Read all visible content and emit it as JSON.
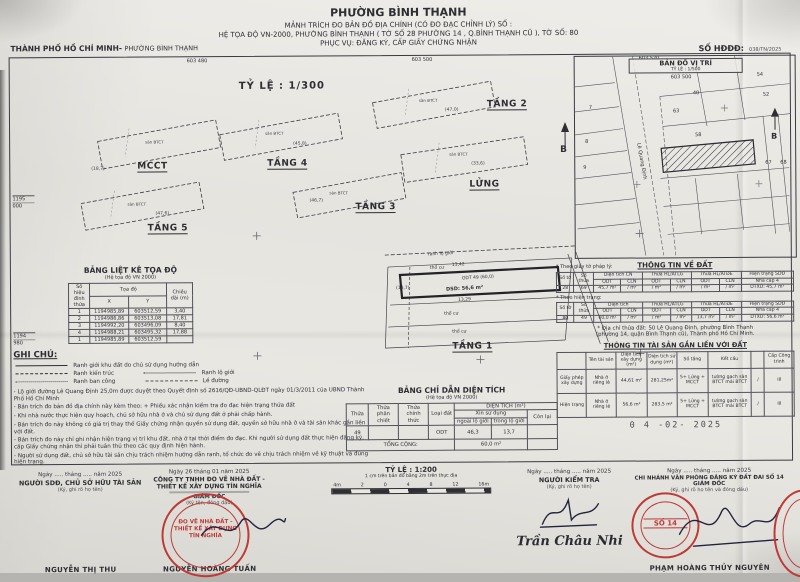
{
  "header": {
    "left_bold": "THÀNH PHỐ HỒ CHÍ MINH-",
    "left_rest": "PHƯỜNG BÌNH THẠNH",
    "title": "PHƯỜNG BÌNH THẠNH",
    "line1": "MẢNH TRÍCH ĐO BẢN ĐỒ ĐỊA CHÍNH (CÓ ĐO ĐẠC CHỈNH LÝ) SỐ :",
    "line2": "HỆ TỌA ĐỘ VN-2000, PHƯỜNG BÌNH THẠNH ( TỜ SỐ 28 PHƯỜNG 14 , Q.BÌNH THẠNH CŨ ), TỜ SỐ: 80",
    "line3": "PHỤC VỤ: ĐĂNG KÝ, CẤP GIẤY CHỨNG NHẬN",
    "so_hddd_label": "SỐ HĐĐĐ:",
    "so_hddd_value": "038/TN/2025"
  },
  "map": {
    "scale_label": "TỶ LỆ : 1/300",
    "coords_top": [
      "603 480",
      "603 500",
      "603 520"
    ],
    "coords_left": [
      "1195",
      "000",
      "1194",
      "980"
    ],
    "north": "B",
    "floors": [
      {
        "label": "MCCT",
        "area": "(18,7)",
        "note": "sàn BTCT"
      },
      {
        "label": "TẦNG 4",
        "area": "(45,8)",
        "note": "sàn BTCT"
      },
      {
        "label": "TẦNG 2",
        "area": "(47,0)",
        "note": "sàn BTCT"
      },
      {
        "label": "TẦNG 5",
        "area": "(47,6)",
        "note": "sàn BTCT"
      },
      {
        "label": "TẦNG 3",
        "area": "(46,7)",
        "note": "sàn BTCT"
      },
      {
        "label": "LỬNG",
        "area": "(33,6)",
        "note": "sàn BTCT"
      },
      {
        "label": "TẦNG 1"
      }
    ],
    "tang1": {
      "ranh": "ranh lộ giới",
      "dim_top": "13,42",
      "odt": "ODT  49  (60,0)",
      "dsd": "DSD: 56,6 m²",
      "dim_bot": "13,29",
      "left_area": "(18,7)",
      "tho_cu": "thổ cư"
    }
  },
  "inset": {
    "title": "BẢN ĐỒ VỊ TRÍ",
    "scale": "TỶ LỆ : 1/500",
    "north": "B",
    "coord": "603 500",
    "street": "Lê Quang Định",
    "parcels": [
      "7",
      "8",
      "9",
      "40",
      "63",
      "52",
      "54",
      "58",
      "67",
      "68"
    ]
  },
  "toado": {
    "title": "BẢNG LIỆT KÊ TỌA ĐỘ",
    "subtitle": "(Hệ tọa độ VN 2000)",
    "col_point": "Số hiệu đỉnh thửa",
    "col_coord": "Tọa độ",
    "col_x": "X",
    "col_y": "Y",
    "col_len": "Chiều dài (m)",
    "rows": [
      [
        "1",
        "1194985,89",
        "603512,59",
        "3,40"
      ],
      [
        "2",
        "1194986,86",
        "603513,08",
        "17,81"
      ],
      [
        "3",
        "1194992,20",
        "603496,09",
        "8,40"
      ],
      [
        "4",
        "1194988,21",
        "603495,32",
        "17,88"
      ],
      [
        "1",
        "1194985,89",
        "603512,59",
        ""
      ]
    ]
  },
  "ghichu": {
    "title": "GHI CHÚ:",
    "leg1": "Ranh giới khu đất do chủ sử dụng hướng dẫn",
    "leg2a": "Ranh kiến trúc",
    "leg2b": "Ranh lộ giới",
    "leg3a": "Ranh ban công",
    "leg3b": "Lề đường",
    "notes": [
      "- Lộ giới đường Lê Quang Định 25,0m được duyệt theo Quyết định số 2616/QĐ-UBND-QLĐT ngày 01/3/2011 của UBND Thành Phố Hồ Chí Minh",
      "- Bản trích đo bản đồ địa chính này kèm theo: + Phiếu xác nhận kiểm tra đo đạc hiện trạng thửa đất",
      "- Khi nhà nước thực hiện quy hoạch, chủ sở hữu nhà ở và chủ sử dụng đất ở phải chấp hành.",
      "- Bản trích đo này không có giá trị thay thế Giấy chứng nhận quyền sử dụng đất, quyền sở hữu nhà ở và tài sản khác gắn liền với đất.",
      "- Bản trích đo này chỉ ghi nhận hiện trạng vị trí khu đất, nhà ở tại thời điểm đo đạc. Khi người sử dụng đất thực hiện đăng ký, cấp Giấy chứng nhận thì phải tuân thủ theo các quy định hiện hành.",
      "- Người sử dụng đất, chủ sở hữu tài sản chịu trách nhiệm hướng dẫn ranh, tổ chức đo vẽ chịu trách nhiệm về kỹ thuật và đúng hiện trạng."
    ]
  },
  "dientich": {
    "title": "BẢNG CHỈ DẪN DIỆN TÍCH",
    "subtitle": "(Hệ tọa độ VN 2000)",
    "h_thua": "Thửa",
    "h_phanchiet": "Thửa phân chiết",
    "h_chinhthuc": "Thửa chính thức",
    "h_loaidat": "Loại đất",
    "h_dientich": "DIỆN TÍCH (m²)",
    "h_xinsudung": "Xin sử dụng",
    "h_conlai": "Còn lại",
    "h_ngoai": "ngoài lộ giới",
    "h_trong": "trong lộ giới",
    "row": [
      "49",
      "",
      "",
      "ODT",
      "46,3",
      "13,7",
      ""
    ],
    "total_label": "TỔNG CỘNG:",
    "total_value": "60,0 m²"
  },
  "dat": {
    "title": "THÔNG TIN VỀ ĐẤT",
    "note_legal": "* Theo giấy tờ pháp lý:",
    "note_current": "* Theo hiện trạng:",
    "h_soto": "Số tờ",
    "h_sothua": "Số thửa",
    "h_dtcn": "Diện tích CN",
    "h_dt": "Diện tích",
    "h_hl": "Thửa HL/ATLG",
    "h_atde": "Thửa HL/ATĐE",
    "h_ht": "Hiện trạng SDĐ",
    "h_odt": "ODT",
    "h_cln": "CLN",
    "h_nha": "Nhà cấp 4",
    "legal_row": [
      [
        "28",
        "69",
        "45,7 m²",
        "/ m²",
        "/ m²",
        "/ m²",
        "/ m²",
        "/ m²",
        "DTXD: 45,7 m²"
      ]
    ],
    "current_row": [
      [
        "80",
        "49",
        "60,0 m²",
        "/ m²",
        "/ m²",
        "/ m²",
        "13,7 m²",
        "/ m²",
        "DTXD: 56,6 m²"
      ]
    ],
    "address1": "* Địa chỉ thửa đất: 50 Lê Quang Định, phường Bình Thạnh",
    "address2": "(phường 14, quận Bình Thạnh cũ), Thành phố Hồ Chí Minh."
  },
  "taisan": {
    "title": "THÔNG TIN TÀI SẢN GẮN LIỀN VỚI ĐẤT",
    "h_ten": "Tên tài sản",
    "h_dtxd": "Diện tích xây dựng (m²)",
    "h_dtsd": "Diện tích sử dụng (m²)",
    "h_sotang": "Số tầng",
    "h_ketcau": "Kết cấu",
    "h_cap": "Cấp Công trình",
    "rows": [
      [
        "Giấy phép xây dựng",
        "Nhà ở riêng lẻ",
        "44,61 m²",
        "281,25m²",
        "5+ Lửng + MCCT",
        "tường gạch sàn BTCT mái BTCT",
        "/",
        "III"
      ],
      [
        "Hiện trạng",
        "Nhà ở riêng lẻ",
        "56,6 m²",
        "283,5 m²",
        "5+ Lửng + MCCT",
        "tường gạch sàn BTCT mái BTCT",
        "/",
        "III"
      ]
    ],
    "date_stamp": "0 4  -02-  2025"
  },
  "signatures": {
    "s1": {
      "date": "Ngày ..... tháng ..... năm 2025",
      "role": "NGƯỜI SDĐ, CHỦ SỞ HỮU TÀI SẢN",
      "note": "(Ký, ghi rõ họ tên)",
      "name": "NGUYỄN THỊ THU"
    },
    "s2": {
      "date": "Ngày 26 tháng 01 năm 2025",
      "org1": "CÔNG TY TNHH ĐO VẼ NHÀ ĐẤT -",
      "org2": "THIẾT KẾ XÂY DỰNG TÍN NGHĨA",
      "role": "GIÁM ĐỐC",
      "note": "(Ký tên, đóng dấu)",
      "name": "NGUYỄN HOÀNG TUẤN",
      "stamp": [
        "ĐO VẼ NHÀ ĐẤT -",
        "THIẾT KẾ XÂY DỰNG",
        "TÍN NGHĨA"
      ]
    },
    "scale200": {
      "label": "TỶ LỆ : 1:200",
      "sub": "1 cm trên bản đồ bằng 2m trên thực địa",
      "ticks": [
        "4m",
        "2",
        "0",
        "4",
        "8",
        "12",
        "16m"
      ]
    },
    "s3": {
      "date": "Ngày ..... tháng ..... năm 2025",
      "role": "NGƯỜI KIỂM TRA",
      "note": "(Ký, ghi rõ họ tên)",
      "script": "Trần Châu Nhi"
    },
    "s4": {
      "date": "Ngày ..... tháng ..... năm 2025",
      "org": "CHI NHÁNH VĂN PHÒNG ĐĂNG KÝ ĐẤT ĐAI SỐ 14",
      "role": "GIÁM ĐỐC",
      "note": "(Ký, ghi rõ họ tên và đóng dấu)",
      "name": "PHẠM HOÀNG THỦY NGUYÊN",
      "stamp_no": "SỐ 14"
    }
  }
}
